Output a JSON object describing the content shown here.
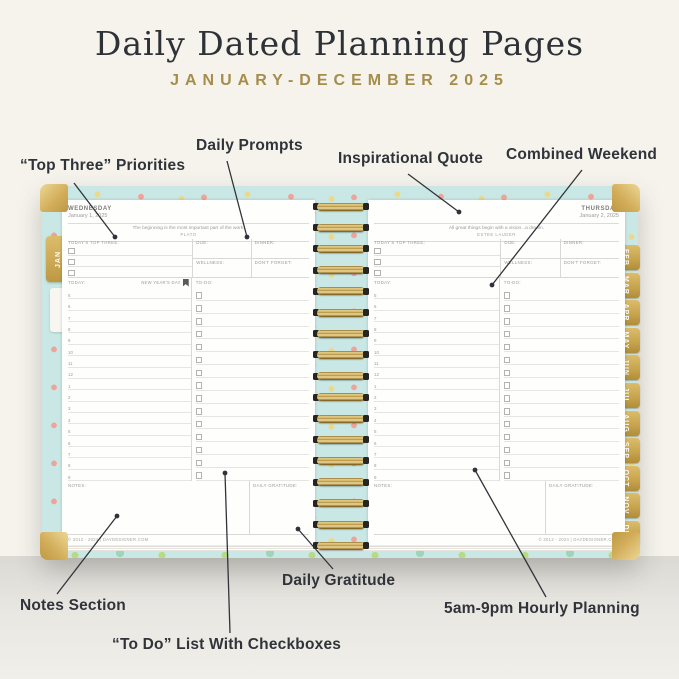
{
  "page": {
    "title": "Daily Dated Planning Pages",
    "subtitle": "JANUARY-DECEMBER 2025"
  },
  "callouts": [
    {
      "id": "top-three-priorities",
      "label": "“Top Three” Priorities",
      "x": 20,
      "y": 157,
      "line": [
        74,
        183,
        115,
        237
      ]
    },
    {
      "id": "daily-prompts",
      "label": "Daily Prompts",
      "x": 196,
      "y": 137,
      "line": [
        227,
        161,
        247,
        237
      ]
    },
    {
      "id": "inspirational-quote",
      "label": "Inspirational Quote",
      "x": 338,
      "y": 150,
      "line": [
        408,
        174,
        459,
        212
      ]
    },
    {
      "id": "combined-weekend",
      "label": "Combined Weekend",
      "x": 506,
      "y": 146,
      "line": [
        582,
        170,
        492,
        285
      ]
    },
    {
      "id": "notes-section",
      "label": "Notes Section",
      "x": 20,
      "y": 597,
      "line": [
        57,
        594,
        117,
        516
      ]
    },
    {
      "id": "todo-list",
      "label": "“To Do” List With Checkboxes",
      "x": 112,
      "y": 636,
      "line": [
        230,
        633,
        225,
        473
      ]
    },
    {
      "id": "daily-gratitude",
      "label": "Daily Gratitude",
      "x": 282,
      "y": 572,
      "line": [
        333,
        569,
        298,
        529
      ]
    },
    {
      "id": "hourly-planning",
      "label": "5am-9pm Hourly Planning",
      "x": 444,
      "y": 600,
      "line": [
        546,
        597,
        475,
        470
      ]
    }
  ],
  "planner": {
    "left_page": {
      "weekday": "WEDNESDAY",
      "date": "January 1, 2025",
      "quote": "The beginning is the most important part of the work.",
      "quote_author": "PLATO",
      "holiday": "NEW YEAR'S DAY",
      "footer": "© 2012 - 2024 | DAYDESIGNER.COM"
    },
    "right_page": {
      "weekday": "THURSDAY",
      "date": "January 2, 2025",
      "quote": "All great things begin with a vision...a dream.",
      "quote_author": "ESTEE LAUDER",
      "footer": "© 2012 - 2024 | DAYDESIGNER.COM"
    },
    "labels": {
      "top_three": "TODAY'S TOP THREE:",
      "due": "DUE:",
      "dinner": "DINNER:",
      "wellness": "WELLNESS:",
      "dont_forget": "DON'T FORGET:",
      "today": "TODAY:",
      "todo": "TO-DO:",
      "notes": "NOTES:",
      "gratitude": "DAILY GRATITUDE:"
    },
    "hours": [
      "5",
      "6",
      "7",
      "8",
      "9",
      "10",
      "11",
      "12",
      "1",
      "2",
      "3",
      "4",
      "5",
      "6",
      "7",
      "8",
      "9"
    ],
    "todo_rows": 15,
    "top_three_rows": 3,
    "month_tabs": [
      "FEB",
      "MAR",
      "APR",
      "MAY",
      "JUN",
      "JUL",
      "AUG",
      "SEP",
      "OCT",
      "NOV",
      "DEC"
    ],
    "left_tab": "JAN",
    "spiral_loops": 17
  },
  "colors": {
    "background": "#f5f3ec",
    "title": "#2e3237",
    "subtitle_gold": "#a58d4b",
    "callout_text": "#30343a",
    "cover_aqua": "#c9e8e5",
    "gold": "#c6a24c",
    "page_white": "#fefefd",
    "rule_gray": "#d9d8d5",
    "text_gray": "#9b9b98"
  }
}
